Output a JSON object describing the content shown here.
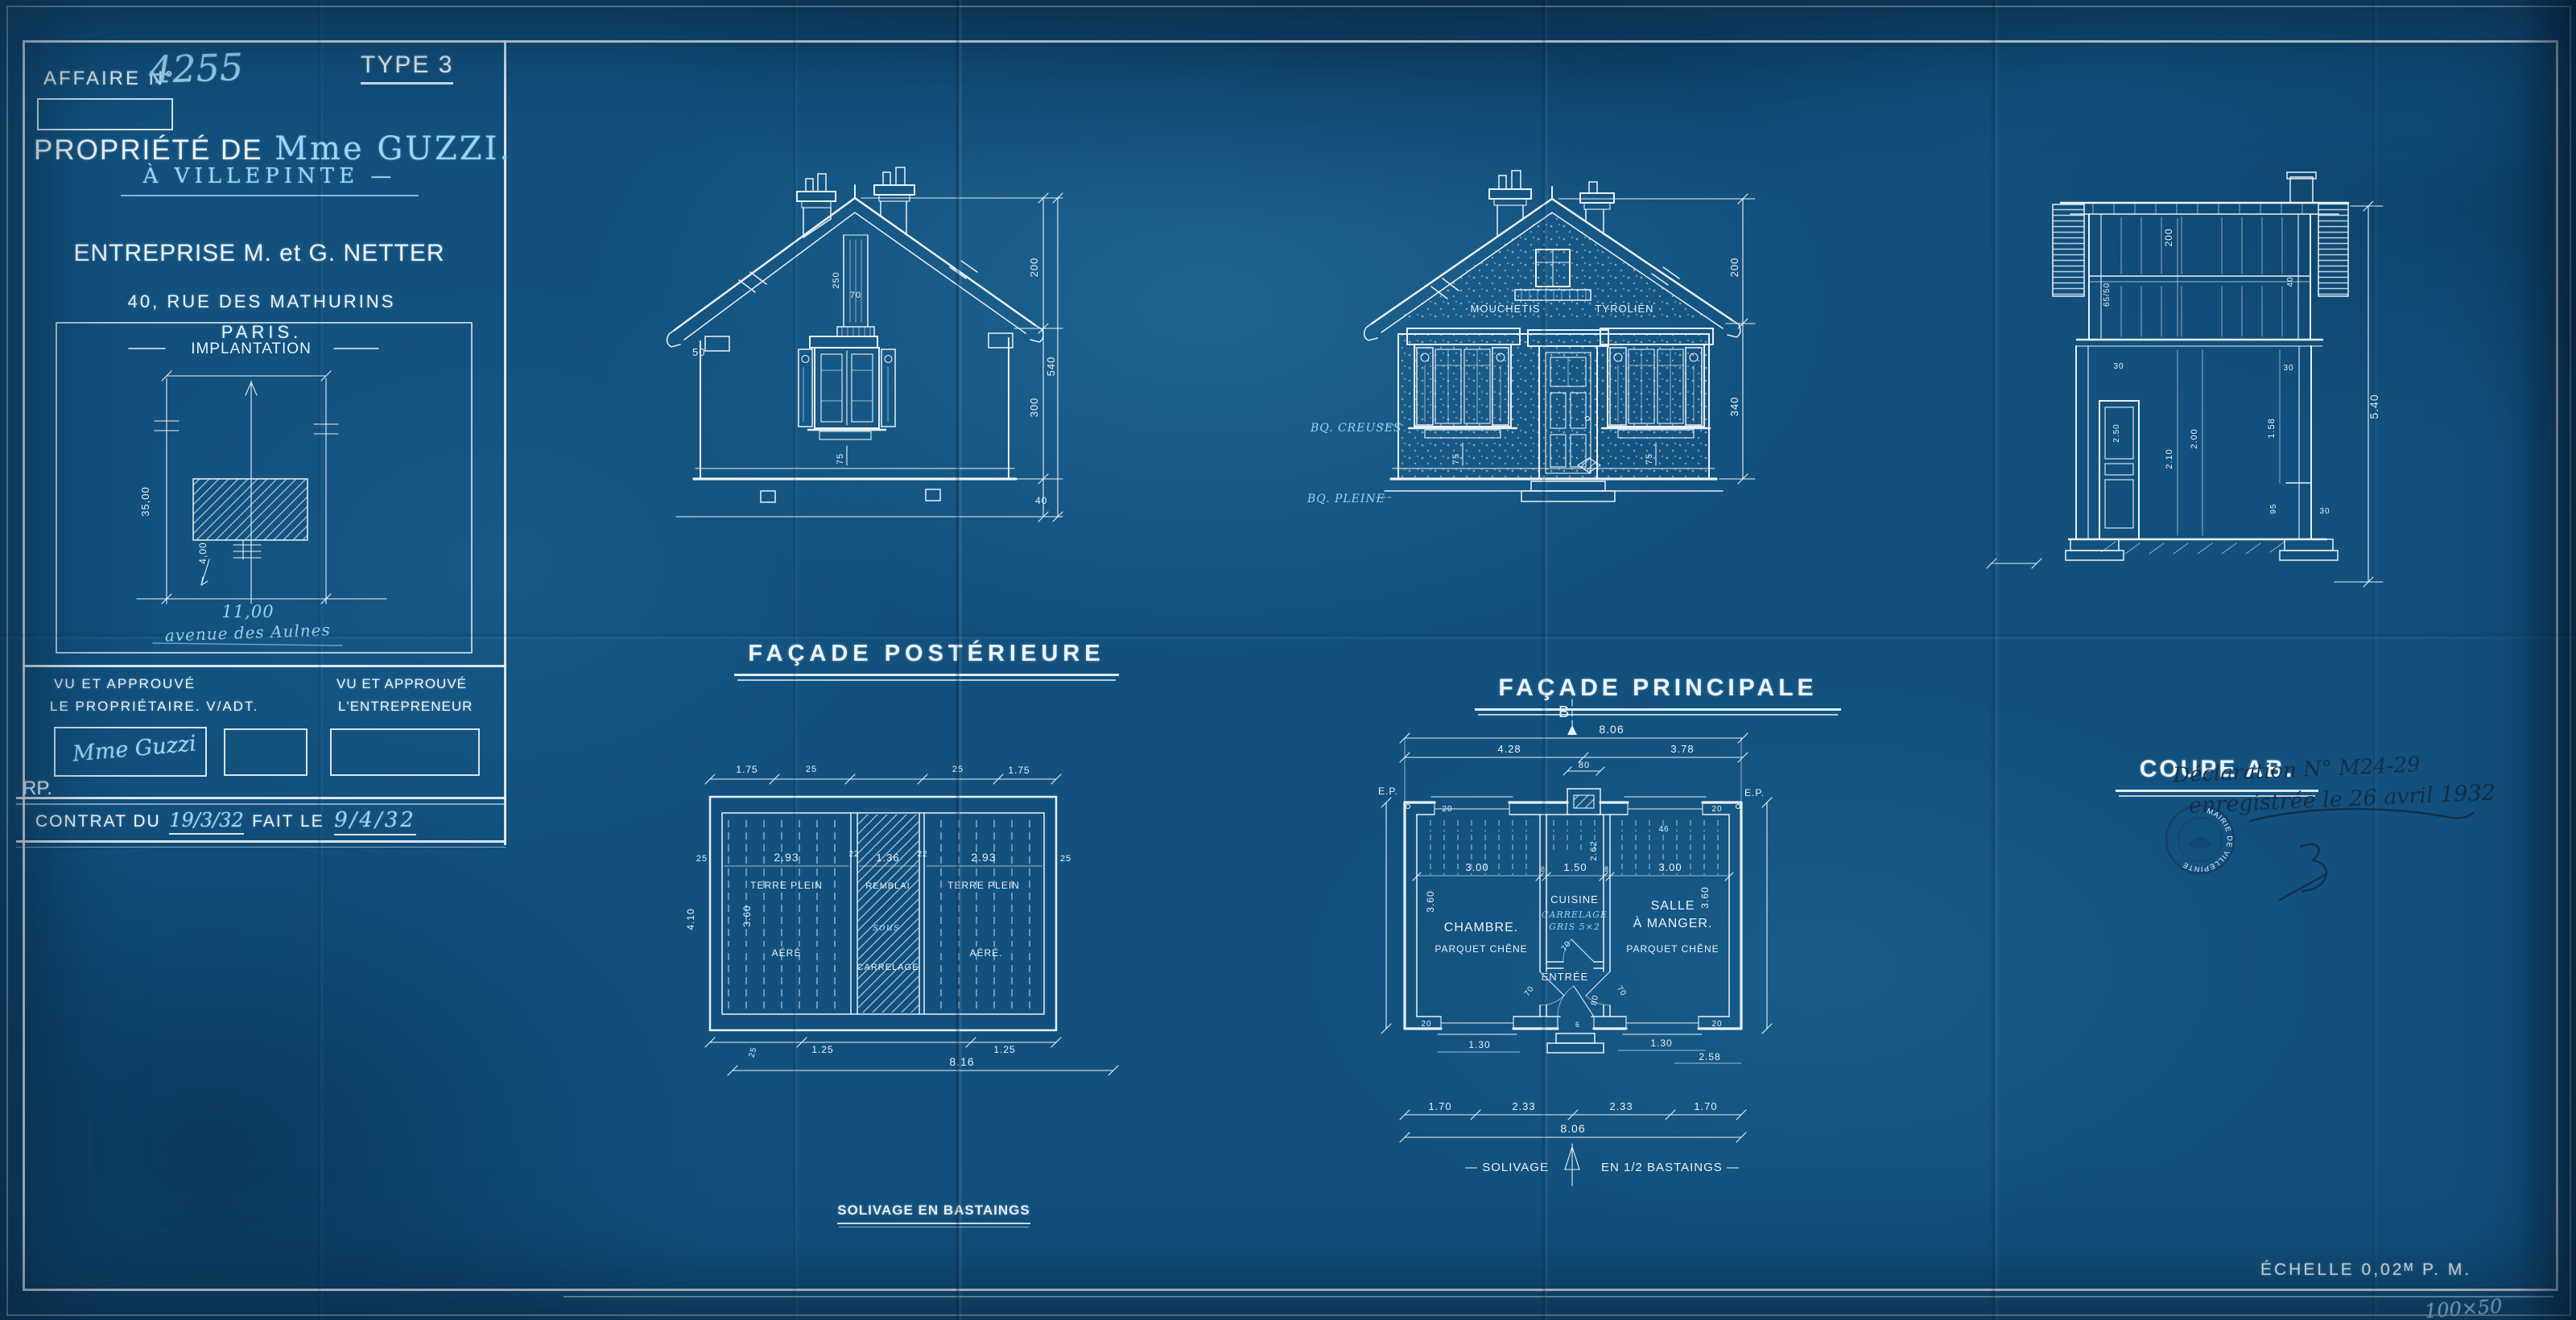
{
  "title_block": {
    "affaire_label": "AFFAIRE N°",
    "affaire_number": "4255",
    "type_label": "TYPE 3",
    "property_label": "PROPRIÉTÉ DE",
    "owner_name": "Mme GUZZI.",
    "location": "À VILLEPINTE —",
    "company": "ENTREPRISE M. et G. NETTER",
    "address_line1": "40, RUE DES MATHURINS",
    "address_line2": "PARIS."
  },
  "implantation": {
    "title": "IMPLANTATION",
    "depth": "35,00",
    "setback": "4,00",
    "frontage": "11,00",
    "street": "avenue des Aulnes"
  },
  "approval": {
    "owner_title1": "VU ET APPROUVÉ",
    "owner_title2": "LE PROPRIÉTAIRE. V/ADT.",
    "contractor_title1": "VU ET APPROUVÉ",
    "contractor_title2": "L'ENTREPRENEUR",
    "owner_signature": "Mme Guzzi",
    "initials": "RP."
  },
  "contract": {
    "label1": "CONTRAT DU",
    "date1": "19/3/32",
    "label2": "FAIT LE",
    "date2": "9/4/32"
  },
  "facade_post": {
    "caption": "FAÇADE POSTÉRIEURE",
    "d200": "200",
    "d300": "300",
    "d540": "540",
    "d40": "40",
    "d50": "50",
    "d250": "250",
    "d70": "70",
    "d75": "75"
  },
  "facade_main": {
    "caption": "FAÇADE PRINCIPALE",
    "render1": "MOUCHETIS",
    "render2": "TYROLIEN",
    "wall1": "BQ. CREUSES",
    "wall2": "BQ. PLEINE",
    "d200": "200",
    "d340": "340",
    "d75l": "75",
    "d75r": "75"
  },
  "coupe": {
    "caption": "COUPE AB.",
    "d200": "200",
    "d6550": "65/50",
    "d40": "40",
    "d30l": "30",
    "d30r": "30",
    "d250": "2.50",
    "d210": "2.10",
    "d200b": "2.00",
    "d158": "1.58",
    "d95": "95",
    "d30b": "30",
    "d540": "5.40"
  },
  "solivage": {
    "caption": "SOLIVAGE EN BASTAINGS",
    "t175a": "1.75",
    "t25a": "25",
    "t25b": "25",
    "t175b": "1.75",
    "l25": "25",
    "r25": "25",
    "v410": "4.10",
    "v360": "3.60",
    "c293a": "2.93",
    "terre_a": "TERRE PLEIN",
    "aere_a": "AÉRÉ",
    "w22a": "22",
    "c136": "1.36",
    "remblai": "REMBLAI",
    "sous": "sous",
    "carrelage": "CARRELAGE",
    "w22b": "22",
    "c293b": "2.93",
    "terre_b": "TERRE PLEIN",
    "aere_b": "AÉRÉ.",
    "b25": "25",
    "b125a": "1.25",
    "b125b": "1.25",
    "total": "8.16"
  },
  "rdc": {
    "caption": "REZ DE CHAUSSÉE",
    "subtitle_a": "— SOLIVAGE",
    "subtitle_b": "EN 1/2 BASTAINGS —",
    "marker_b": "B",
    "t806": "8.06",
    "t428": "4.28",
    "t378": "3.78",
    "t80": "80",
    "ep_l": "E.P.",
    "ep_r": "E.P.",
    "d400l": "4.00",
    "d400r": "4.00",
    "d20tl": "20",
    "d20tr": "20",
    "d20bl": "20",
    "d20br": "20",
    "s300a": "3.00",
    "s8a": "8",
    "s150": "1.50",
    "s8b": "8",
    "s300b": "3.00",
    "v360l": "3.60",
    "v360r": "3.60",
    "v262": "2.62",
    "d46": "46",
    "chambre": "CHAMBRE.",
    "chambre_floor": "PARQUET CHÊNE",
    "cuisine": "CUISINE",
    "cuisine_floor1": "CARRELAGE",
    "cuisine_floor2": "GRIS 5×2",
    "salle1": "SALLE",
    "salle2": "À MANGER.",
    "salle_floor": "PARQUET CHÊNE",
    "entree": "ENTRÉE",
    "door70l": "70",
    "door70c": "70",
    "door70r": "70",
    "door80": "80",
    "d6": "6",
    "w130l": "1.30",
    "w130r": "1.30",
    "d258": "2.58",
    "b170a": "1.70",
    "b233a": "2.33",
    "b233b": "2.33",
    "b170b": "1.70",
    "total": "8.06"
  },
  "annotations": {
    "decl1": "Déclaration N° M24-29",
    "decl2": "enregistrée le 26 avril 1932",
    "stamp_text": "MAIRIE DE VILLEPINTE",
    "size_note": "100×50"
  },
  "scale_note": "ÉCHELLE 0,02ᴹ P. M."
}
